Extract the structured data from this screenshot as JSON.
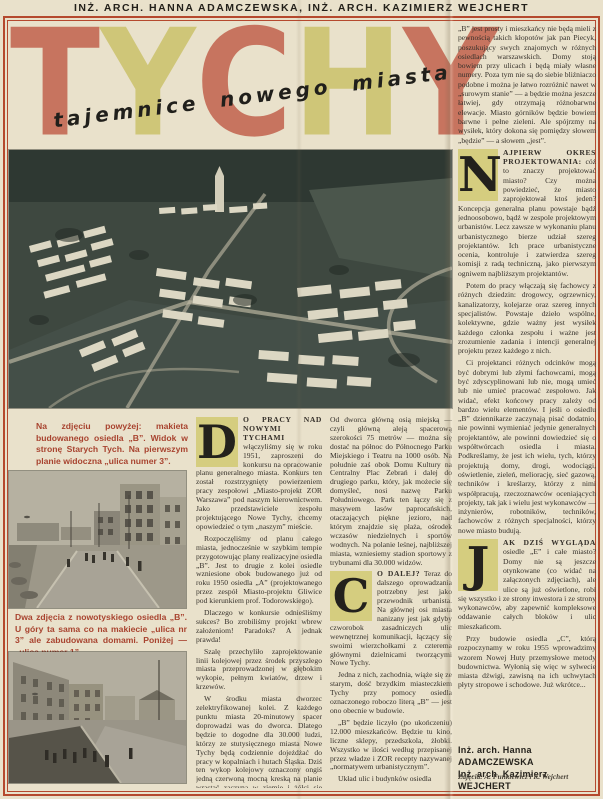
{
  "header": {
    "credits_line": "INŻ. ARCH. HANNA ADAMCZEWSKA, INŻ. ARCH. KAZIMIERZ WEJCHERT"
  },
  "title": {
    "word": "TYCHY",
    "letters": [
      "T",
      "Y",
      "C",
      "H",
      "Y"
    ],
    "letter_colors": [
      "#c7745f",
      "#cfc678",
      "#c7745f",
      "#cfc678",
      "#c7745f"
    ],
    "subtitle": "tajemnice nowego miasta",
    "accent_salmon": "#c7745f",
    "accent_olive": "#cfc678",
    "frame_red": "#b5492e",
    "dropcap_yellow": "#d5cd7f",
    "caption_red": "#a8432f"
  },
  "captions": {
    "aerial": "Na zdjęciu powyżej: makieta budowanego osiedla „B”. Widok w stronę Starych Tych. Na pierwszym planie widoczna „ulica numer 3”.",
    "streets": "Dwa zdjęcia z nowotyskiego osiedla „B”. U góry ta sama co na makiecie „ulica nr 3” ale zabudowana domami. Poniżej — „ulica numer 1”."
  },
  "col_left": {
    "dropcap": "D",
    "lead_bold": "O PRACY NAD NOWYMI TYCHAMI",
    "lead_rest": " włączyliśmy się w roku 1951, zaproszeni do konkursu na opracowanie planu generalnego miasta. Konkurs ten został rozstrzygnięty powierzeniem pracy zespołowi „Miasto-projekt ZOR Warszawa” pod naszym kierownictwem. Jako przedstawiciele zespołu projektującego Nowe Tychy, chcemy opowiedzieć o tym „naszym” mieście.",
    "paras": [
      "Rozpoczęliśmy od planu całego miasta, jednocześnie w szybkim tempie przygotowując plany realizacyjne osiedla „B”. Jest to drugie z kolei osiedle wzniesione obok budowanego już od roku 1950 osiedla „A” (projektowanego przez zespół Miasto-projektu Gliwice pod kierunkiem prof. Todorowskiego).",
      "Dlaczego w konkursie odnieśliśmy sukces? Bo zrobiliśmy projekt wbrew założeniom! Paradoks? A jednak prawda!",
      "Szalę przechyliło zaprojektowanie linii kolejowej przez środek przyszłego miasta przeprowadzonej w głębokim wykopie, pełnym kwiatów, drzew i krzewów.",
      "W środku miasta dworzec zelektryfikowanej kolei. Z każdego punktu miasta 20-minutowy spacer doprowadzi was do dworca. Dlatego będzie to dogodne dla 30.000 ludzi, którzy ze stutysięcznego miasta Nowe Tychy będą codziennie dojeżdżać do pracy w kopalniach i hutach Śląska. Dziś ten wykop kolejowy oznaczony ongiś jedną czerwoną mocną kreską na planie wrastać zaczyna w ziemię i żółci się piaskiem i brunatną glinką."
    ]
  },
  "col_mid": {
    "para_top": "Od dworca główną osią miejską — czyli główną aleją spacerową szerokości 75 metrów — można się dostać na północ do Północnego Parku Miejskiego i Teatru na 1000 osób. Na południe zaś obok Domu Kultury na Centralny Plac Zebrań i dalej do drugiego parku, który, jak możecie się domyśleć, nosi nazwę Parku Południowego. Park ten łączy się z masywem lasów paprocańskich, otaczających piękne jezioro, nad którym znajdzie się plaża, ośrodek wczasów niedzielnych i sportów wodnych. Na polanie leśnej, najbliższej miasta, wzniesiemy stadion sportowy z trybunami dla 30.000 widzów.",
    "dropcap": "C",
    "lead_bold": "O DALEJ?",
    "lead_rest": " Teraz do dalszego oprowadzania potrzebny jest jako przewodnik urbanista. Na głównej osi miasta nanizany jest jak gdyby czworobok zasadniczych ulic wewnętrznej komunikacji, łączący się swoimi wierzchołkami z czterema głównymi dzielnicami tworzącymi Nowe Tychy.",
    "paras": [
      "Jedna z nich, zachodnia, wiąże się ze starym, dość brzydkim miasteczkiem Tychy przy pomocy osiedla oznaczonego roboczo literą „B” — jest ono obecnie w budowie.",
      "„B” będzie liczyło (po ukończeniu) 12.000 mieszkańców. Będzie tu kino, liczne sklepy, przedszkola, żłobki. Wszystko w ilości według przepisanej przez władze i ZOR recepty nazywanej „normatywem urbanistycznym”.",
      "Układ ulic i budynków osiedla"
    ]
  },
  "col_right": {
    "para_top": "„B” jest prosty i mieszkańcy nie będą mieli z pewnością takich kłopotów jak pan Piecyk, poszukujący swych znajomych w różnych osiedlach warszawskich. Domy stoją bowiem przy ulicach i będą miały własne numery. Poza tym nie są do siebie bliźniaczo podobne i można je łatwo rozróżnić nawet w „surowym stanie” — a będzie można jeszcze łatwiej, gdy otrzymają różnobarwne elewacje. Miasto górników będzie bowiem barwne i pełne zieleni. Ale spójrzmy na wysiłek, który dokona się pomiędzy słowem „będzie” — a słowem „jest”.",
    "section_n": {
      "dropcap": "N",
      "lead_bold": "AJPIERW OKRES PROJEKTOWANIA:",
      "lead_rest": " cóż to znaczy projektować miasto? Czy można powiedzieć, że miasto zaprojektował ktoś jeden? Koncepcja generalna planu powstaje bądź jednoosobowo, bądź w zespole projektowym urbanistów. Lecz zawsze w wykonaniu planu urbanistycznego bierze udział szereg projektantów. Ich prace urbanistyczne ocenia, kontroluje i zatwierdza szereg komisji z radą techniczną, jako pierwszym ogniwem najbliższym projektantów.",
      "paras": [
        "Potem do pracy włączają się fachowcy z różnych dziedzin: drogowcy, ogrzewnicy, kanalizatorzy, kolejarze oraz szereg innych specjalistów. Powstaje dzieło wspólne, kolektywne, gdzie ważny jest wysiłek każdego członka zespołu i ważne jest zrozumienie zadania i intencji generalnej projektu przez każdego z nich.",
        "Ci projektanci różnych odcinków mogą być dobrymi lub złymi fachowcami, mogą być zdyscyplinowani lub nie, mogą umieć lub nie umieć pracować zespołowo. Jak widać, efekt końcowy pracy zależy od bardzo wielu elementów. I jeśli o osiedlu „B” dziennikarze zaczynają pisać dodatnio, nie powinni wymieniać jedynie generalnych projektantów, ale powinni dowiedzieć się o współtwórcach osiedla i miasta. Podkreślamy, że jest ich wielu, tych, którzy projektują domy, drogi, wodociągi, oświetlenie, zieleń, meliorację, sieć gazową, techników i kreślarzy, którzy z nimi współpracują, rzeczoznawców oceniających projekty, tak jak i wielu jest wykonawców — inżynierów, robotników, techników, fachowców z różnych specjalności, którzy nowe miasto budują."
      ]
    },
    "section_j": {
      "dropcap": "J",
      "lead_bold": "AK DZIŚ WYGLĄDA",
      "lead_rest": " osiedle „E” i całe miasto? Domy nie są jeszcze otynkowane (co widać na załączonych zdjęciach), ale ulice są już oświetlone, robi się wszystko i ze strony inwestora i ze strony wykonawców, aby zapewnić kompleksowe oddawanie całych bloków i ulic mieszkańcom.",
      "paras": [
        "Przy budowie osiedla „C”, którą rozpoczynamy w roku 1955 wprowadzimy wzorem Nowej Huty przemysłowe metody budownictwa. Wyłonią się więc w sylwecie miasta dźwigi, zawisną na ich uchwytach płyty stropowe i schodowe. Już wkrótce..."
      ]
    },
    "credits": [
      "Inż. arch. Hanna ADAMCZEWSKA",
      "Inż. arch. Kazimierz WEJCHERT"
    ],
    "photo_credit": "Zdjęcia: A. Funkiewicz i K. Wejchert"
  }
}
